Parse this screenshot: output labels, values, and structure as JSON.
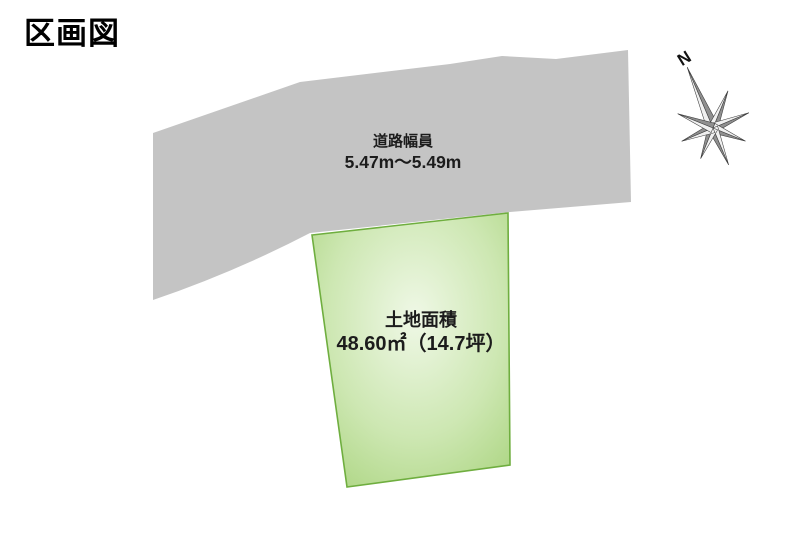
{
  "page": {
    "title": "区画図"
  },
  "road": {
    "name_label": "道路幅員",
    "width_value": "5.47m～5.49m",
    "fill_color": "#c4c4c4"
  },
  "parcel": {
    "name_label": "土地面積",
    "area_value": "48.60㎡（14.7坪）",
    "border_color": "#6fae3f",
    "fill_center_color": "#eff8e6",
    "fill_mid_color": "#cde7b2",
    "fill_edge_color": "#a8d37c"
  },
  "compass": {
    "north_label": "N",
    "ray_light_color": "#f0f0f0",
    "ray_dark_color": "#8f8f8f",
    "outline_color": "#3a3a3a"
  }
}
